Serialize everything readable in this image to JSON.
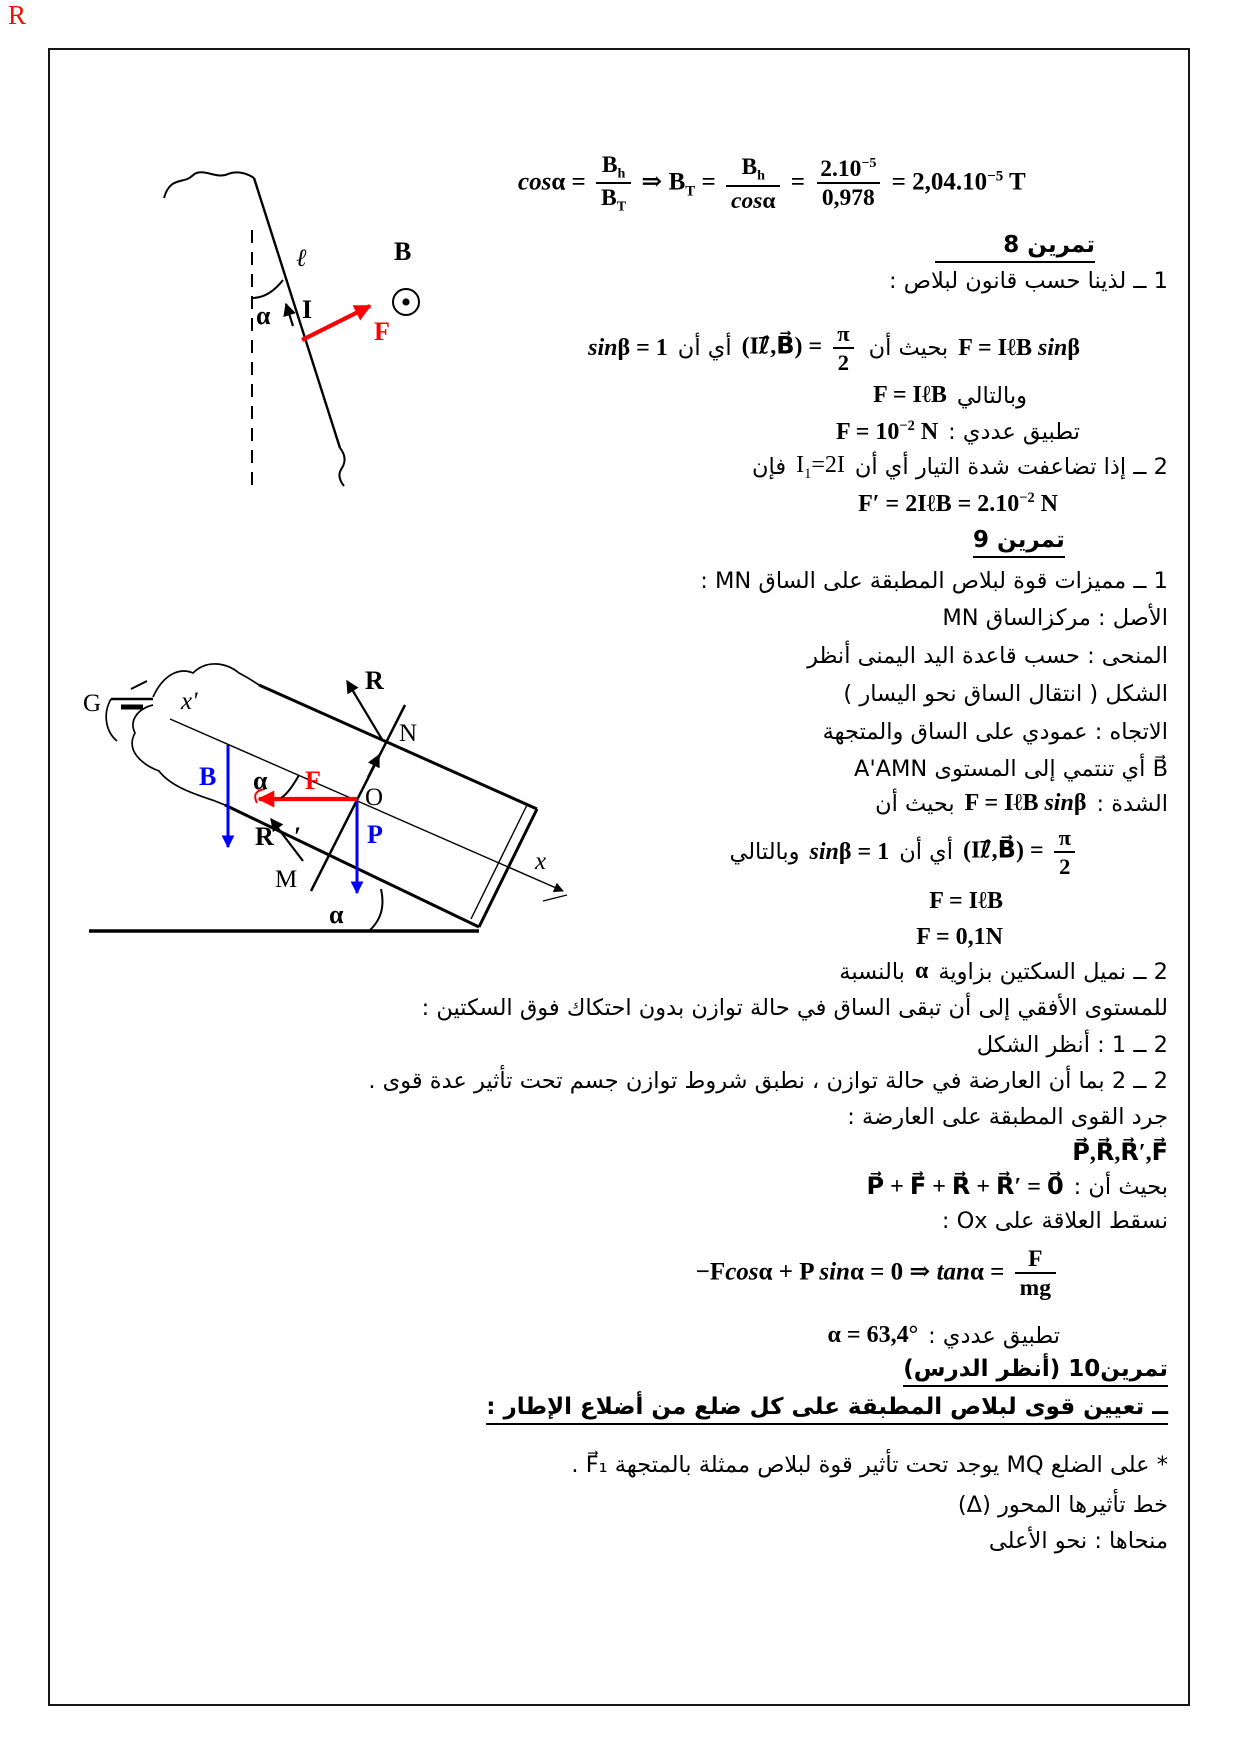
{
  "page": {
    "corner_mark": "R"
  },
  "colors": {
    "vector_red": "#ff0000",
    "vector_blue": "#0000ff",
    "ink": "#000000",
    "frame": "#161616",
    "corner_mark": "#f01000"
  },
  "eq_top": [
    {
      "i": "cos"
    },
    "α = ",
    {
      "frac": {
        "num": [
          "B",
          {
            "sub": "h"
          }
        ],
        "den": [
          "B",
          {
            "sub": "T"
          }
        ]
      }
    },
    " ⇒ B",
    {
      "sub": "T"
    },
    " = ",
    {
      "frac": {
        "num": [
          "B",
          {
            "sub": "h"
          }
        ],
        "den": [
          {
            "i": "cos"
          },
          "α"
        ]
      }
    },
    " = ",
    {
      "frac": {
        "num": [
          "2.10",
          {
            "sup": "−5"
          }
        ],
        "den": [
          "0,978"
        ]
      }
    },
    " = 2,04.10",
    {
      "sup": "−5"
    },
    " T"
  ],
  "ex8": {
    "title": "تمرين 8",
    "intro": "1 ــ لذينا حسب قانون لبلاص :",
    "law_math": [
      "F = IℓB ",
      {
        "i": "sin"
      },
      "β"
    ],
    "such_that": "بحيث أن",
    "angle_math": [
      "(Iℓ⃗,B⃗) = ",
      {
        "frac": {
          "num": [
            "π"
          ],
          "den": [
            "2"
          ]
        }
      }
    ],
    "ie": "أي أن",
    "sin_math": [
      {
        "i": "sin"
      },
      "β = 1"
    ],
    "hence": "وبالتالي",
    "result_math": [
      "F = IℓB"
    ],
    "numeric_label": "تطبيق عددي :",
    "numeric_math": [
      "F = 10",
      {
        "sup": "−2"
      },
      " N"
    ],
    "q2_a": "2 ــ إذا تضاعفت شدة التيار أي أن",
    "q2_math": [
      "I",
      {
        "sub": "1"
      },
      "=2I"
    ],
    "q2_b": "فإن",
    "q2_result": [
      "F′ = 2IℓB = 2.10",
      {
        "sup": "−2"
      },
      " N"
    ]
  },
  "ex9": {
    "title": "تمرين 9",
    "l1": "1 ــ مميزات قوة لبلاص المطبقة على الساق MN :",
    "l2": "الأصل : مركزالساق MN",
    "l3": "المنحى : حسب قاعدة اليد اليمنى أنظر",
    "l4": "الشكل ( انتقال الساق نحو اليسار )",
    "l5": "الاتجاه : عمودي على الساق والمتجهة",
    "l6": "B⃗ أي تنتمي إلى المستوى A'AMN",
    "l7_label": "الشدة :",
    "l7_math": [
      "F = IℓB ",
      {
        "i": "sin"
      },
      "β"
    ],
    "l7_such": "بحيث أن",
    "l8_math1": [
      "(Iℓ⃗,B⃗) = ",
      {
        "frac": {
          "num": [
            "π"
          ],
          "den": [
            "2"
          ]
        }
      }
    ],
    "l8_ie": "أي أن",
    "l8_math2": [
      {
        "i": "sin"
      },
      "β = 1"
    ],
    "l8_hence": "وبالتالي",
    "f1": [
      "F = IℓB"
    ],
    "f2": [
      "F = 0,1N"
    ],
    "q2_a": "2 ــ نميل السكتين بزاوية",
    "q2_alpha": [
      "α"
    ],
    "q2_b": "بالنسبة",
    "q2_c": "للمستوى الأفقي إلى أن تبقى الساق في حالة توازن بدون احتكاك فوق السكتين :",
    "q21": "2 ــ 1 : أنظر الشكل",
    "q22": "2 ــ 2 بما أن العارضة في حالة توازن ، نطبق شروط توازن جسم تحت تأثير عدة قوى .",
    "forces_label": "جرد القوى المطبقة على العارضة :",
    "forces_math": [
      "P⃗,R⃗,R⃗′,F⃗"
    ],
    "such_label": "بحيث أن :",
    "sum_math": [
      "P⃗ + F⃗ + R⃗ + R⃗′ = 0⃗"
    ],
    "project": "نسقط العلاقة على Ox :",
    "proj_eq": [
      "−F",
      {
        "i": "cos"
      },
      "α + P ",
      {
        "i": "sin"
      },
      "α = 0 ⇒ ",
      {
        "i": "tan"
      },
      "α = ",
      {
        "frac": {
          "num": [
            "F"
          ],
          "den": [
            "mg"
          ]
        }
      }
    ],
    "numeric_label": "تطبيق عددي :",
    "numeric_math": [
      "α = 63,4°"
    ]
  },
  "ex10": {
    "title": "تمرين10 (أنظر الدرس)",
    "subtitle": "ــ تعيين قوى لبلاص المطبقة على كل ضلع من أضلاع الإطار :",
    "l1": "* على الضلع MQ يوجد تحت تأثير قوة لبلاص ممثلة بالمتجهة F⃗₁ .",
    "l2": "خط تأثيرها المحور (Δ)",
    "l3": "منحاها : نحو الأعلى"
  },
  "diagram1": {
    "labels": {
      "alpha": "α",
      "ell": "ℓ",
      "current": "I",
      "field": "B⃗",
      "force": "F⃗"
    }
  },
  "diagram2": {
    "labels": {
      "generator": "G",
      "x_prime": "x'",
      "x": "x",
      "N": "N",
      "O": "O",
      "M": "M",
      "alpha_top": "α",
      "alpha_bottom": "α",
      "reaction": "R⃗",
      "reaction2": "R⃗′",
      "field": "B⃗",
      "force": "F⃗",
      "weight": "P⃗"
    }
  }
}
